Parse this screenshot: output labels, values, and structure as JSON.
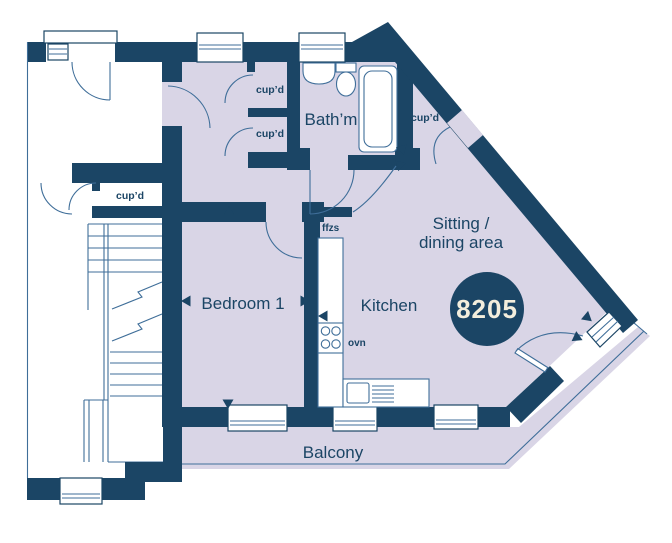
{
  "colors": {
    "wall": "#1b4565",
    "room_fill": "#d9d5e6",
    "fixture_line": "#3f6e99",
    "plot_text": "#f3eedd",
    "background": "#ffffff"
  },
  "plot": {
    "number": "8205"
  },
  "rooms": {
    "bedroom": "Bedroom 1",
    "kitchen": "Kitchen",
    "bathroom": "Bath’m",
    "sitting_line1": "Sitting /",
    "sitting_line2": "dining area",
    "balcony": "Balcony"
  },
  "features": {
    "cupboards": [
      {
        "label": "cup’d"
      },
      {
        "label": "cup’d"
      },
      {
        "label": "cup’d"
      },
      {
        "label": "cup’d"
      }
    ],
    "fridge_freezer_space": "ffzs",
    "oven": "ovn"
  }
}
